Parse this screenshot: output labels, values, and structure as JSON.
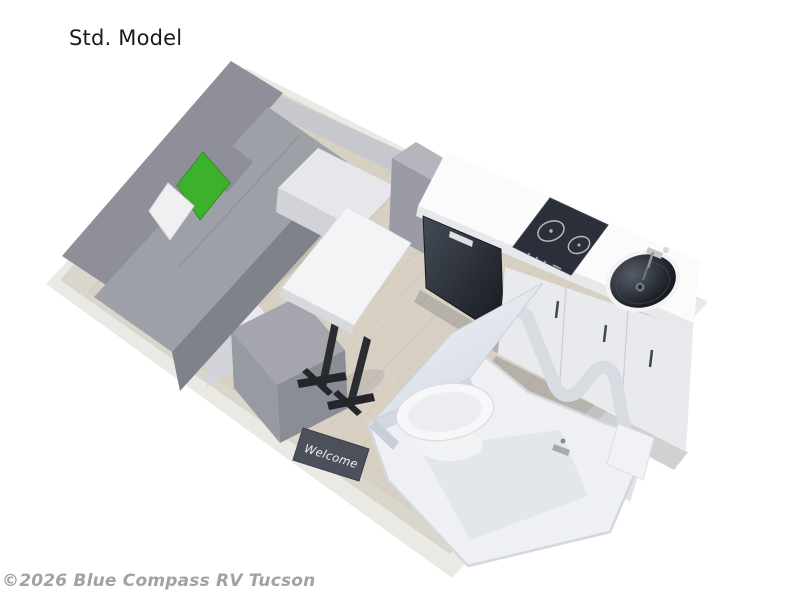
{
  "page": {
    "title": "Std. Model",
    "watermark": "©2026 Blue Compass RV Tucson"
  },
  "floorplan": {
    "welcome_mat_text": "Welcome",
    "colors": {
      "accent_green": "#3eb12c",
      "sofa_gray": "#9ea0a8",
      "wood_floor": "#d7d0c3",
      "appliance_black": "#2a2f3a",
      "counter_white": "#fbfbfc",
      "mat_slate": "#4b505a"
    },
    "features": [
      "Sofa with accent pillows",
      "Pedestal dinette table",
      "Storage ottoman",
      "Refrigerator",
      "Two-burner cooktop",
      "Round sink",
      "Kitchen cabinets",
      "Wet bath with toilet",
      "Welcome mat",
      "Wood-look flooring"
    ]
  }
}
